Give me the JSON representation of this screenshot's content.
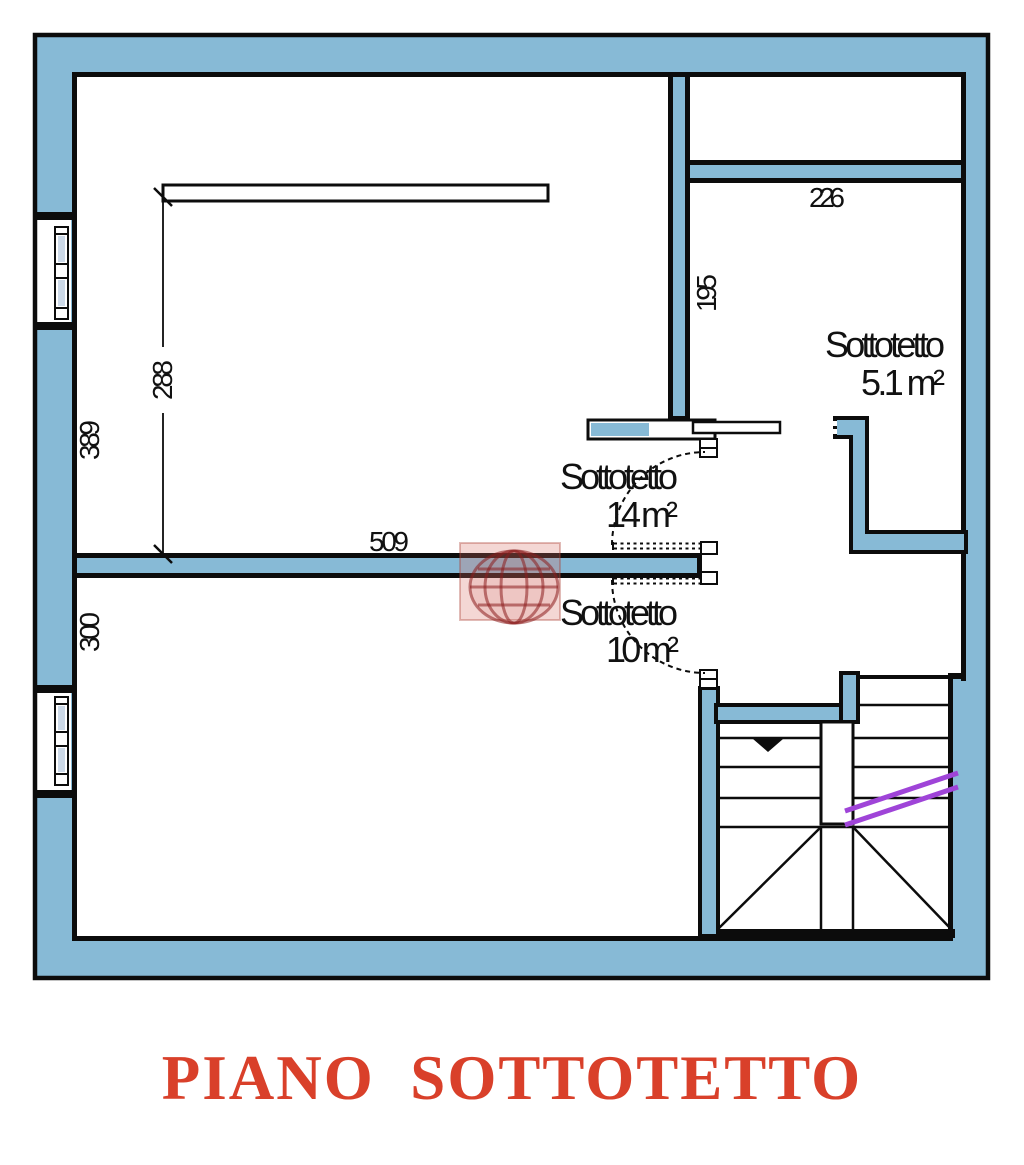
{
  "plan": {
    "title": "PIANO  SOTTOTETTO",
    "dims": {
      "beam_height": "288",
      "room14_height": "389",
      "room10_height": "300",
      "room14_width": "509",
      "room51_width": "226",
      "room51_height": "195"
    },
    "rooms": {
      "r14": {
        "name": "Sottotetto",
        "area": "14 m²"
      },
      "r10": {
        "name": "Sottotetto",
        "area": "10 m²"
      },
      "r51": {
        "name": "Sottotetto",
        "area": "5.1 m²"
      }
    },
    "colors": {
      "wall_fill": "#87bad6",
      "outline": "#0c0c0c",
      "stair_accent": "#9f44d8",
      "title_red": "#d9402a",
      "glazing": "#ccd9e8",
      "watermark": "#a03028"
    }
  }
}
